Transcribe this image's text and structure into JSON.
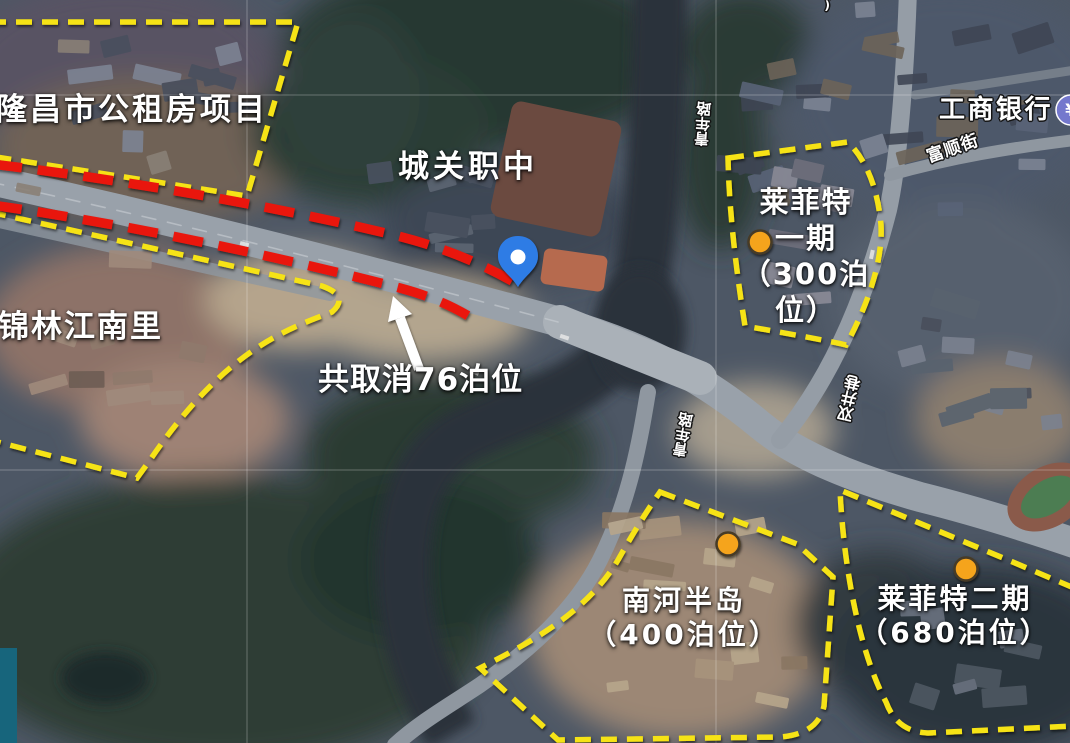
{
  "labels": {
    "public_housing": "隆昌市公租房项目",
    "school": "城关职中",
    "jinlin": "锦林江南里",
    "cancel_note": "共取消76泊位",
    "phase1": {
      "l1": "莱菲特",
      "l2": "一期",
      "l3": "（300泊",
      "l4": "位）"
    },
    "nanhe": {
      "l1": "南河半岛",
      "l2": "（400泊位）"
    },
    "phase2": {
      "l1": "莱菲特二期",
      "l2": "（680泊位）"
    }
  },
  "streets": {
    "qingnian": "青年路",
    "shuangjing": "双井巷",
    "fushun": "富顺街",
    "top_partial": "(第"
  },
  "poi": {
    "bank_name": "工商银行",
    "bank_glyph": "¥"
  },
  "parking_counts": {
    "cancelled_on_road": "76",
    "laifeite_phase1": "300",
    "nanhe_peninsula": "400",
    "laifeite_phase2": "680"
  },
  "colors": {
    "annotation_yellow": "#f6e314",
    "annotation_red": "#e9170c",
    "marker_orange": "#f5a41d",
    "pin_blue": "#2e7be5",
    "bank_purple": "#7478cd",
    "slide_edge_teal": "#17657c"
  }
}
